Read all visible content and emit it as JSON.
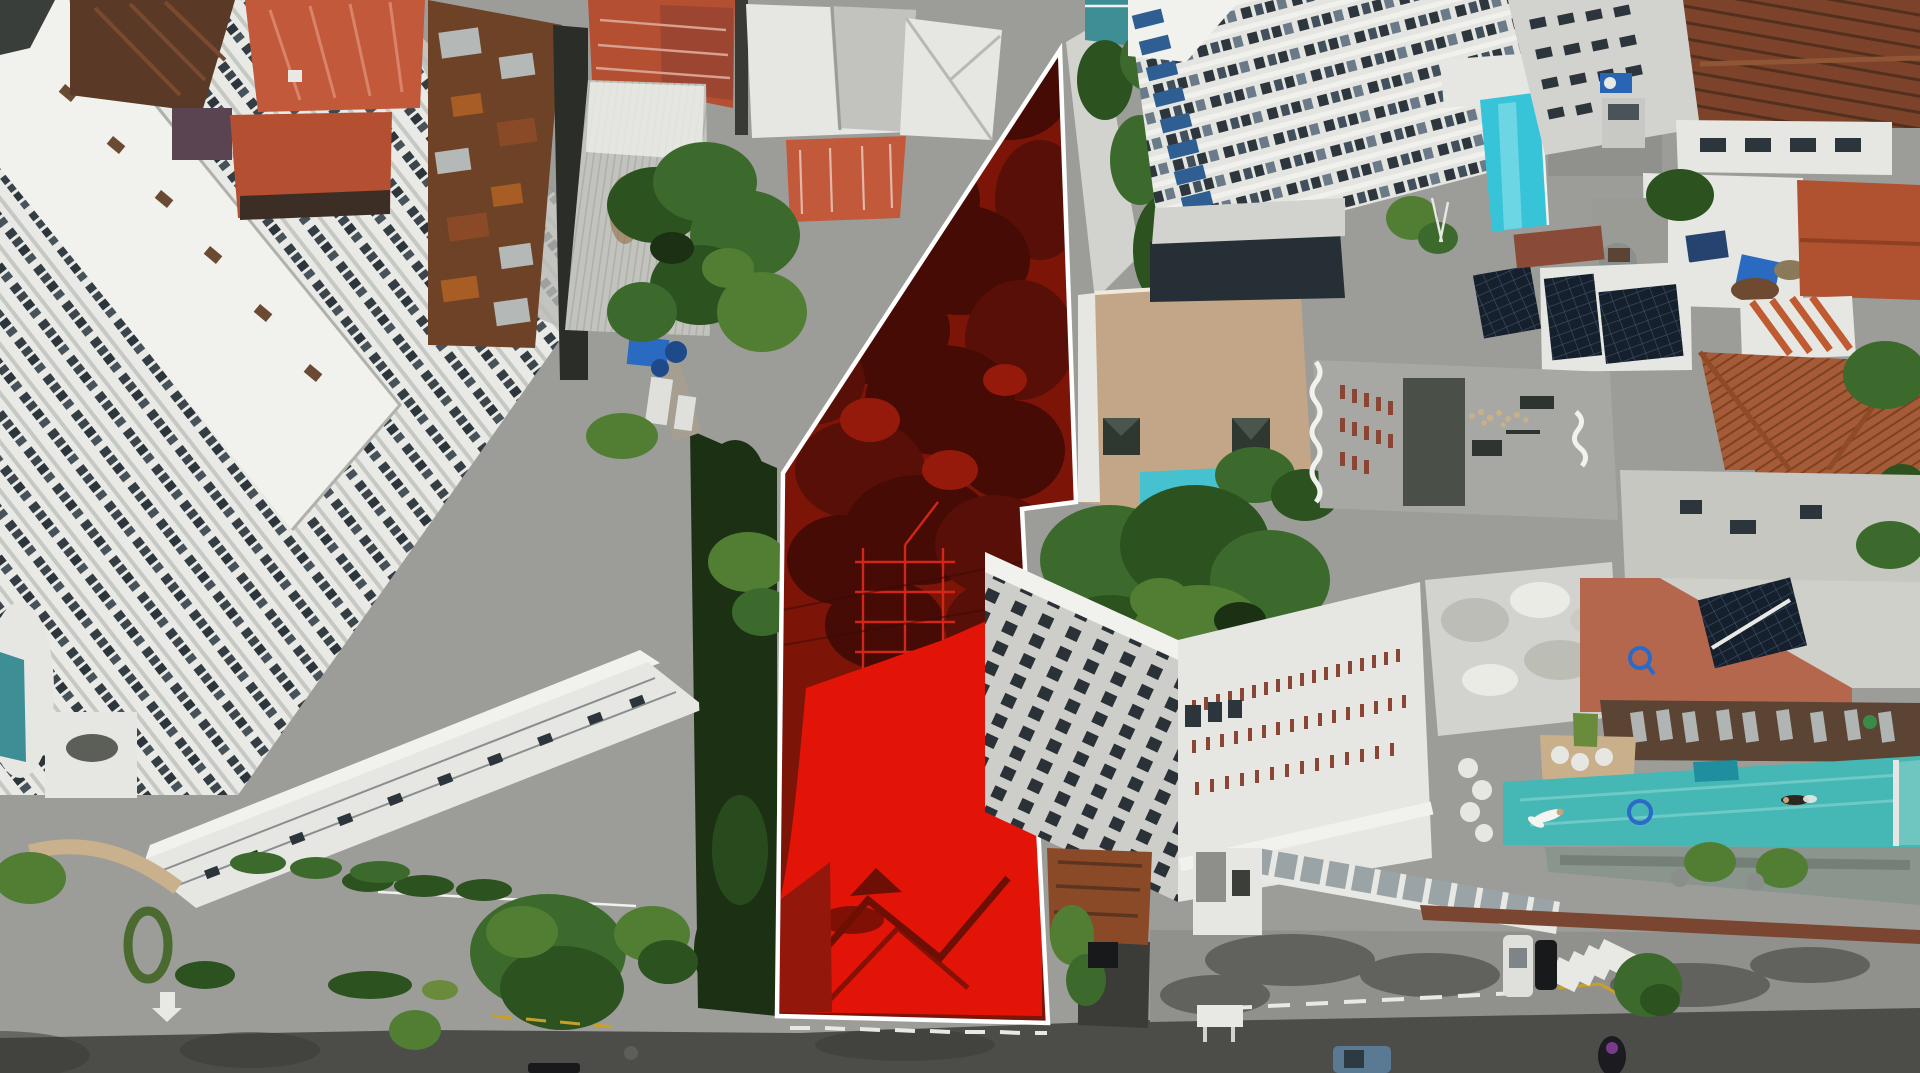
{
  "meta": {
    "title": "Aerial drone photograph of urban block with highlighted development parcel",
    "type": "aerial-photograph",
    "width_px": 1920,
    "height_px": 1073,
    "visible_text": "none"
  },
  "scene": {
    "description": "Top-down drone view of a dense tropical city block. A vacant tree-covered parcel in the center is tinted bright red and outlined with a thick white boundary. It is surrounded by white high-rise towers on the left, rusty corrugated and red metal house roofs at top-center, modern towers with a cyan rooftop pool at top-right, a tan terrace with pyramid skylights, buildings with rooftop solar arrays, terracotta tile roofs at far right, and a large white building with a long turquoise lap pool at bottom-right. Streets with crosswalks, curb markings and vehicles run along the bottom.",
    "highlighted_lot": {
      "label": "highlighted parcel for sale",
      "points": "1060,50 1076,502 1022,509 1048,1023 777,1016 783,473",
      "tint_color": "#7c1408",
      "building_roof_color": "#e21408",
      "border_color": "#ffffff",
      "border_width_px": 4.5,
      "contains": [
        "dense tree canopy (red tinted)",
        "lattice utility scaffold",
        "low building with ridged roof",
        "bare ground at lower left"
      ]
    },
    "landmarks": [
      {
        "name": "terraced white tower",
        "position": "left"
      },
      {
        "name": "white slab apartment building",
        "position": "lower left"
      },
      {
        "name": "rusty corrugated house roofs",
        "position": "top center"
      },
      {
        "name": "warehouse metal roof",
        "position": "top center"
      },
      {
        "name": "balcony tower with rooftop cyan pool",
        "position": "top right"
      },
      {
        "name": "tan roof terrace with two pyramid skylights",
        "position": "right of parcel"
      },
      {
        "name": "rooftop solar panel arrays",
        "position": "right"
      },
      {
        "name": "terracotta tile roofs",
        "position": "far right"
      },
      {
        "name": "hotel-style building with lap pool deck",
        "position": "bottom right"
      },
      {
        "name": "creek corridor with trees",
        "position": "left of parcel"
      }
    ],
    "pool_area": {
      "lap_pool_color": "#45b7b5",
      "swimmers": 2,
      "pool_floor_ring_logo_color": "#2a6ac8",
      "loungers": "rows of grey loungers on wooden deck",
      "palms_below_deck": 2
    },
    "counts": {
      "pyramid_skylights": 2,
      "solar_arrays": 3,
      "pools_visible": 4,
      "blue_water_tanks_cluster": 1
    },
    "street_objects": {
      "crosswalk": "white zebra stripes, bottom right",
      "curb_markings": [
        "white dashed curb line",
        "yellow curb dashes",
        "white pavement arrow"
      ],
      "vehicles": [
        "white car",
        "black car",
        "blue pickup truck",
        "black SUV in driveway",
        "silver pickup in alley",
        "motorbike with rider",
        "dark car bottom center"
      ],
      "signs": [
        "blue parking sign in alley",
        "white street sign bottom right"
      ]
    }
  },
  "colors": {
    "asphalt": "#4c4c48",
    "asphalt_light": "#5e5e59",
    "sidewalk": "#90918d",
    "plaza": "#9c9d99",
    "shadow": "#3b3b37",
    "white_bldg": "#e6e7e3",
    "white_bright": "#f1f1ed",
    "white_dim": "#d2d3cf",
    "slab_shadow": "#c2c3bf",
    "win_dark": "#2b353b",
    "balcony_blue": "#2e5e92",
    "teal_glass": "#3e8e96",
    "pool_cyan": "#38c4d8",
    "pool_teal": "#45b7b5",
    "pool_deep": "#1f8fa0",
    "lot_red": "#7c1408",
    "lot_red_dark": "#450b04",
    "lot_red_dark2": "#570f07",
    "lot_red_lite": "#961a0b",
    "lot_roof": "#e21408",
    "lot_ridge": "#6e0f05",
    "lot_ground": "#93170b",
    "scaffold": "#d2261a",
    "border_white": "#ffffff",
    "rust_dark": "#6e4226",
    "rust_mid": "#8a4a28",
    "rust_lite": "#a85d24",
    "metal_patch": "#b4b9b8",
    "roof_salmon": "#c3593b",
    "roof_redorange": "#b44f31",
    "roof_brown": "#5a3a26",
    "roof_tile": "#a55a38",
    "tile_line": "#7e411f",
    "warehouse": "#c2c3bd",
    "tan_terrace": "#c3a687",
    "tan_deck": "#c9b08b",
    "wood_deck": "#5c4434",
    "orange_block": "#b5674e",
    "green1": "#3c6a2c",
    "green2": "#2c5220",
    "green3": "#517e33",
    "green_dark": "#1c3014",
    "lawn": "#6a8a3c",
    "solar": "#15202c",
    "solar_line": "#3e506a",
    "glass_dark": "#262f36",
    "dirt": "#6e4a30",
    "creek": "#a69e90",
    "blue_tarp": "#2a6ac0",
    "tank_blue": "#1e4a8a",
    "sign_blue": "#2a64b4",
    "yellow_paint": "#c8a028",
    "ring_blue": "#2a6ac8",
    "truck_blue": "#5a7a94",
    "car_white": "#dfe0dc",
    "car_black": "#17191b",
    "car_silver": "#c8c9c5"
  }
}
